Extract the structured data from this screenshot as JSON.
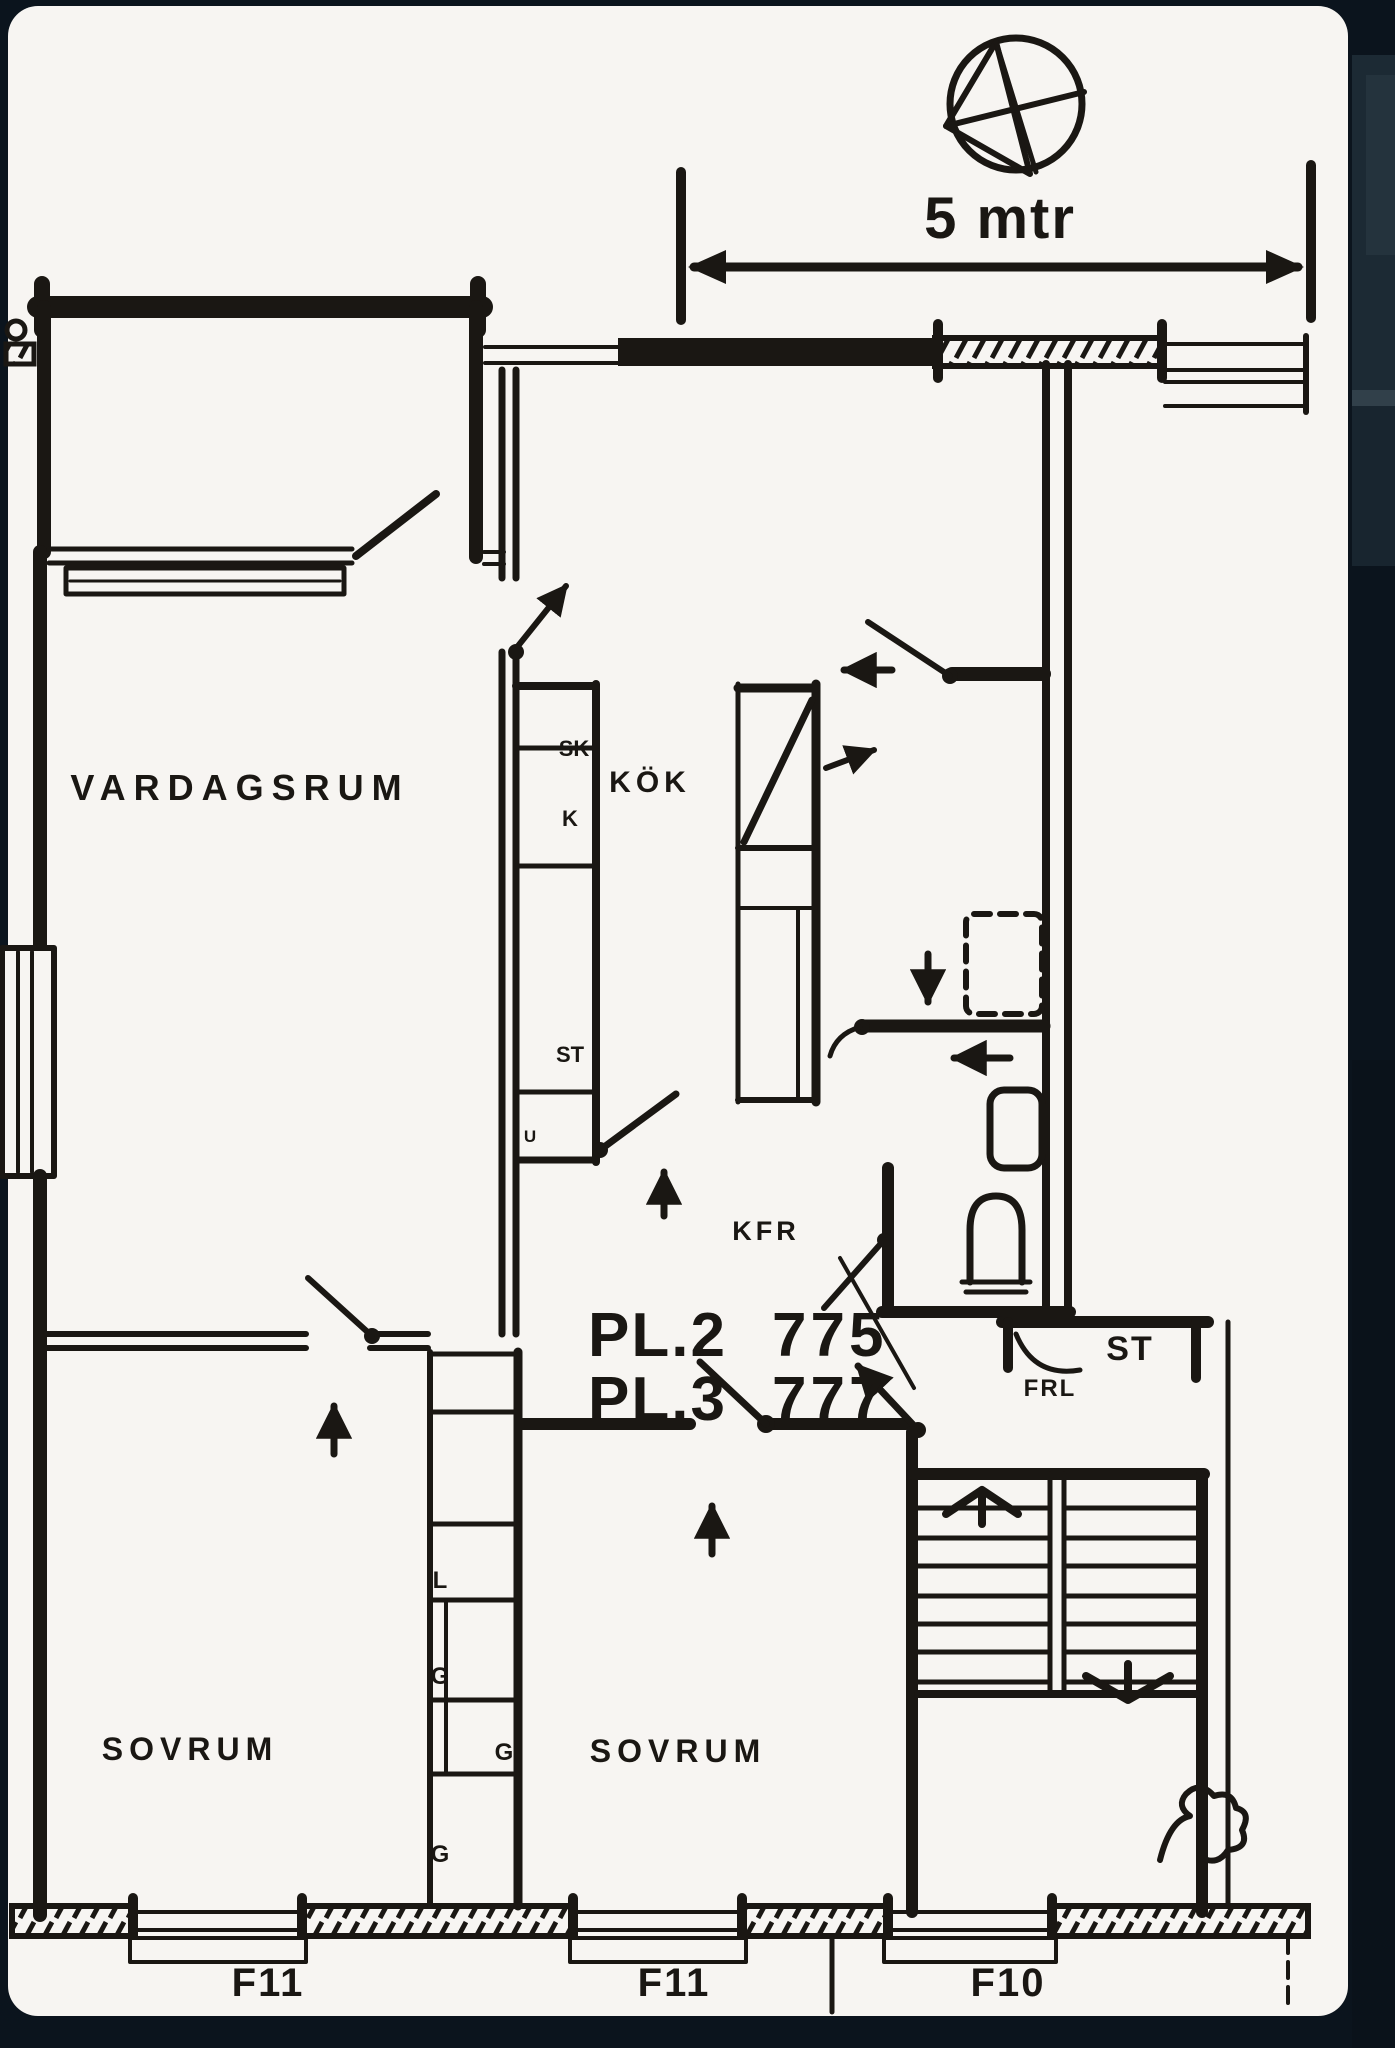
{
  "colors": {
    "ink": "#1a1713",
    "paper": "#f7f5f2",
    "background": "#0b141d",
    "panel": "#1c2a34",
    "panel_light": "#24333d"
  },
  "scale_bar": {
    "label": "5 mtr"
  },
  "compass": {
    "icon": "north-arrow-icon"
  },
  "rooms": {
    "living": "VARDAGSRUM",
    "kitchen": "KÖK",
    "bedroom_left": "SOVRUM",
    "bedroom_right": "SOVRUM"
  },
  "kitchen_units": {
    "sk": "SK",
    "k": "K",
    "st": "ST",
    "u": "U"
  },
  "hall": {
    "kfr": "KFR"
  },
  "closets": {
    "st": "ST",
    "frl": "FRL",
    "l": "L",
    "g1": "G",
    "g2": "G",
    "g3": "G"
  },
  "apartments": {
    "pl2_label": "PL.2",
    "pl2_number": "775",
    "pl3_label": "PL.3",
    "pl3_number": "777"
  },
  "windows": {
    "left": "F11",
    "middle": "F11",
    "right": "F10"
  }
}
